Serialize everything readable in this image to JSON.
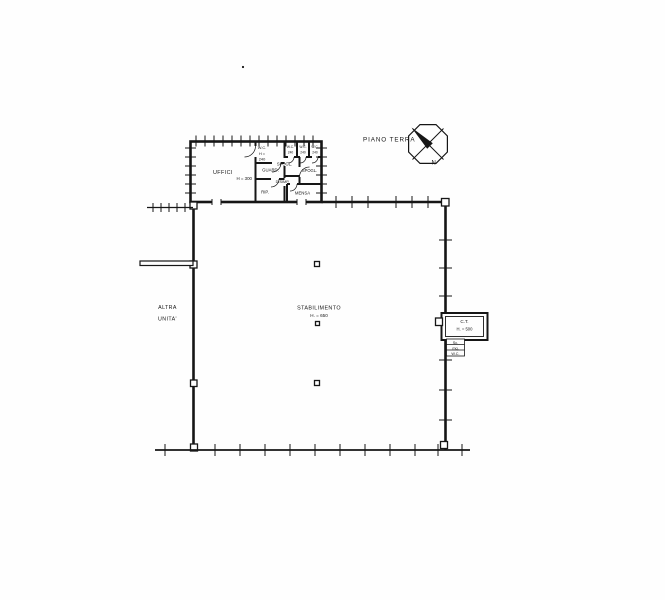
{
  "colors": {
    "ink": "#161616",
    "paper": "#fefefe"
  },
  "drawing": {
    "title": "PIANO TERRA",
    "compass": {
      "north": "N"
    },
    "adjacent_unit": {
      "line1": "ALTRA",
      "line2": "UNITA'"
    },
    "rooms": {
      "uffici": {
        "name": "UFFICI",
        "height": "H = 300"
      },
      "wc_main": {
        "name": "W.C.",
        "height_label": "H =",
        "height_value": "240"
      },
      "guardaroba": {
        "name": "GUARD."
      },
      "ripostiglio": {
        "name": "RIP."
      },
      "spogliatoio_1": {
        "name": "SPOGL."
      },
      "disimpegno": {
        "name": "DISIMP."
      },
      "spogliatoio_2": {
        "name": "SPOGL."
      },
      "mensa": {
        "name": "MENSA"
      },
      "wc_strip": [
        {
          "name": "W.C.",
          "height": "240"
        },
        {
          "name": "W.C.",
          "height": "240"
        },
        {
          "name": "W.C.",
          "height": "240"
        }
      ],
      "stabilimento": {
        "name": "STABILIMENTO",
        "height": "H. = 650"
      },
      "centrale_termica": {
        "name": "C.T.",
        "height": "H. = 500",
        "note_lines": [
          "Sc.",
          "mq.",
          "W.C."
        ]
      }
    }
  }
}
